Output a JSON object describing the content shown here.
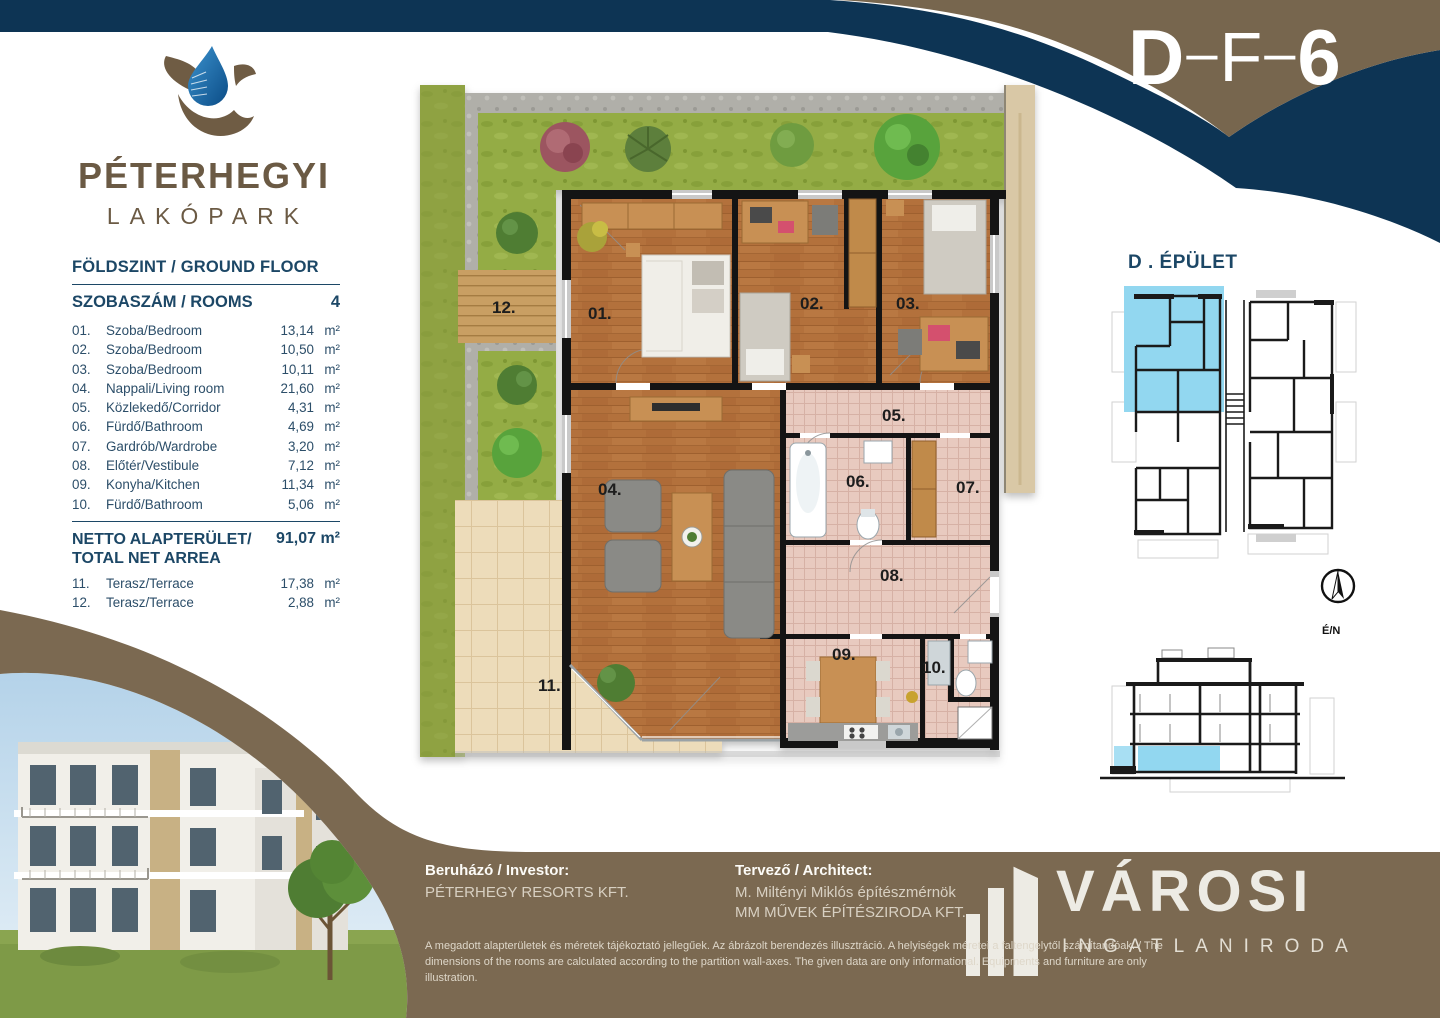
{
  "header": {
    "code_parts": {
      "p0": "D",
      "p1": "–",
      "p2": "F",
      "p3": "–",
      "p4": "6"
    }
  },
  "logo": {
    "line1": "PÉTERHEGYI",
    "line2": "LAKÓPARK"
  },
  "room_table": {
    "floor_title": "FÖLDSZINT / GROUND FLOOR",
    "rooms_header": {
      "label": "SZOBASZÁM / ROOMS",
      "count": "4"
    },
    "rows": [
      {
        "no": "01.",
        "name": "Szoba/Bedroom",
        "area": "13,14",
        "unit": "m²"
      },
      {
        "no": "02.",
        "name": "Szoba/Bedroom",
        "area": "10,50",
        "unit": "m²"
      },
      {
        "no": "03.",
        "name": "Szoba/Bedroom",
        "area": "10,11",
        "unit": "m²"
      },
      {
        "no": "04.",
        "name": "Nappali/Living room",
        "area": "21,60",
        "unit": "m²"
      },
      {
        "no": "05.",
        "name": "Közlekedő/Corridor",
        "area": "4,31",
        "unit": "m²"
      },
      {
        "no": "06.",
        "name": "Fürdő/Bathroom",
        "area": "4,69",
        "unit": "m²"
      },
      {
        "no": "07.",
        "name": "Gardrób/Wardrobe",
        "area": "3,20",
        "unit": "m²"
      },
      {
        "no": "08.",
        "name": "Előtér/Vestibule",
        "area": "7,12",
        "unit": "m²"
      },
      {
        "no": "09.",
        "name": "Konyha/Kitchen",
        "area": "11,34",
        "unit": "m²"
      },
      {
        "no": "10.",
        "name": "Fürdő/Bathroom",
        "area": "5,06",
        "unit": "m²"
      }
    ],
    "total": {
      "label1": "NETTO ALAPTERÜLET/",
      "label2": "TOTAL NET ARREA",
      "value": "91,07 m²"
    },
    "terraces": [
      {
        "no": "11.",
        "name": "Terasz/Terrace",
        "area": "17,38",
        "unit": "m²"
      },
      {
        "no": "12.",
        "name": "Terasz/Terrace",
        "area": "2,88",
        "unit": "m²"
      }
    ]
  },
  "floor_plan": {
    "labels": {
      "r01": "01.",
      "r02": "02.",
      "r03": "03.",
      "r04": "04.",
      "r05": "05.",
      "r06": "06.",
      "r07": "07.",
      "r08": "08.",
      "r09": "09.",
      "r10": "10.",
      "r11": "11.",
      "r12": "12."
    }
  },
  "building_panel": {
    "title": "D . ÉPÜLET",
    "compass_label": "É/N"
  },
  "footer": {
    "investor_label": "Beruházó / Investor:",
    "investor_name": "PÉTERHEGY RESORTS KFT.",
    "architect_label": "Tervező / Architect:",
    "architect_line1": "M. Miltényi Miklós építészmérnök",
    "architect_line2": "MM MŰVEK ÉPÍTÉSZIRODA KFT.",
    "disclaimer_line1": "A megadott alapterületek és méretek tájékoztató jellegűek. Az ábrázolt berendezés illusztráció. A helyiségek méretei a faltengelytől számítandóak. / The dimensions of the rooms are calculated according to",
    "disclaimer_line2": "the partition wall-axes. The given data are only informational. Equipments and furniture are only illustration.",
    "brand": {
      "name": "VÁROSI",
      "subtitle": "INGATLANIRODA"
    }
  },
  "colors": {
    "navy": "#0d3454",
    "band_brown": "#77664e",
    "footer_brown": "#7b6951",
    "logo_brown": "#6b5a44",
    "highlight_blue": "#92d7f0"
  }
}
